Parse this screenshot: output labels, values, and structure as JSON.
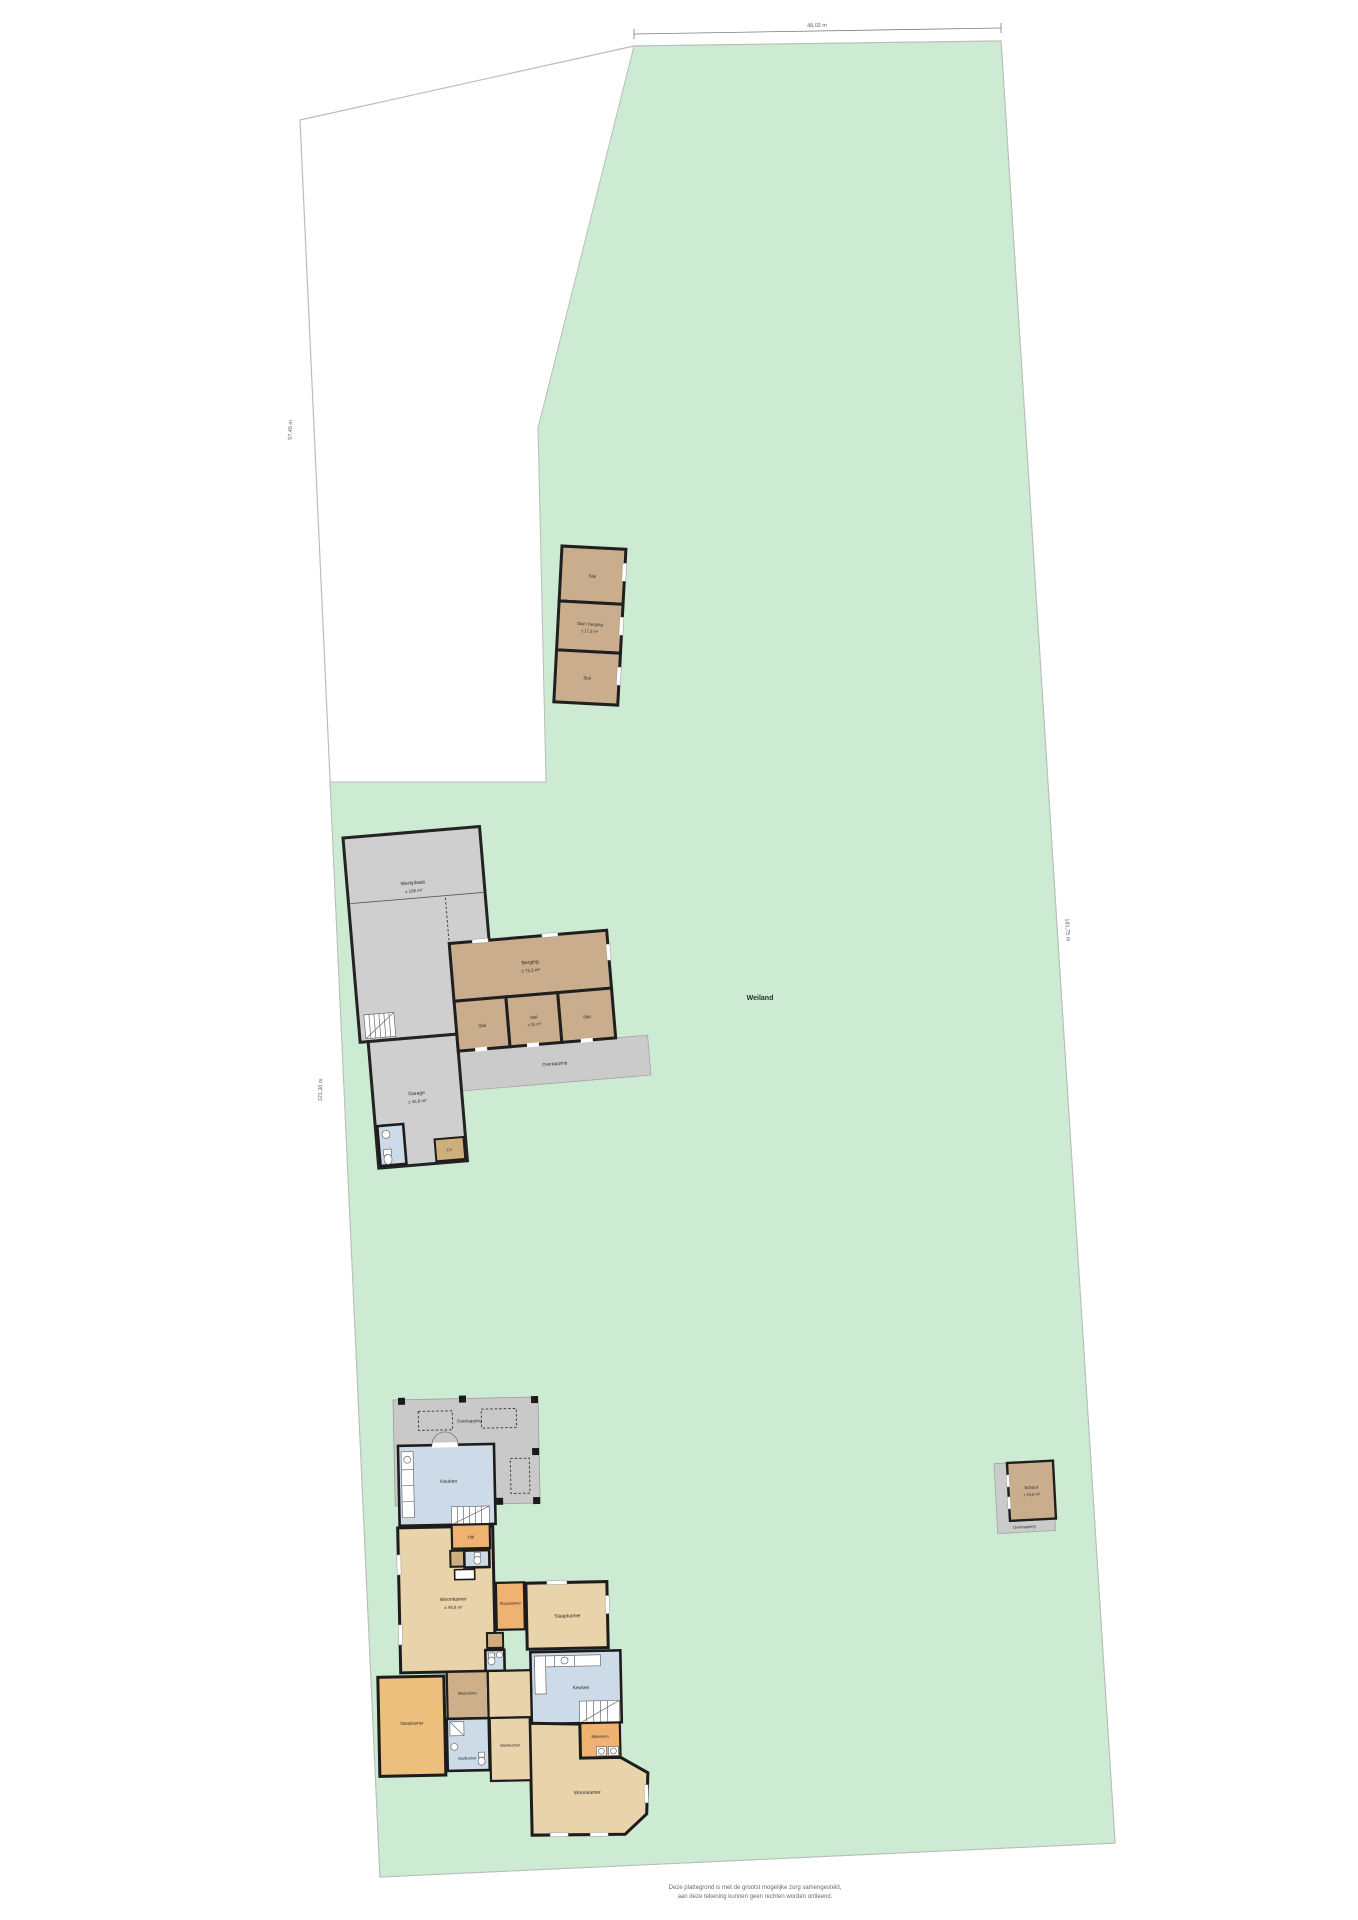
{
  "plan": {
    "field_label": "Weiland",
    "footer_line1": "Deze plattegrond is met de grootst mogelijke zorg samengesteld,",
    "footer_line2": "aan deze tekening kunnen geen rechten worden ontleend.",
    "dimensions": {
      "top": "48,02 m",
      "left_upper": "57,45 m",
      "left_lower": "121,30 m",
      "right": "181,75 m"
    }
  },
  "stable_north": {
    "room1": "Stal",
    "room2_name": "Stal / berging",
    "room2_area": "± 17,2 m²",
    "room3": "Stal"
  },
  "barn": {
    "hall_name": "Werkplaats",
    "hall_area": "± 168 m²",
    "berging_name": "Berging",
    "berging_area": "± 72,5 m²",
    "stal_left": "Stal",
    "stal_mid_name": "Stal",
    "stal_mid_area": "± 15 m²",
    "stal_right": "Stal",
    "overkapping": "Overkapping",
    "garage_name": "Garage",
    "garage_area": "± 46,8 m²",
    "cv": "CV"
  },
  "house": {
    "terrace": "Overkapping",
    "kitchen1": "Keuken",
    "hall": "Hal",
    "living1_name": "Woonkamer",
    "living1_area": "± 48,6 m²",
    "bedroom1": "Slaapkamer",
    "bedroom2": "Slaapkamer",
    "kitchen2": "Keuken",
    "bijkeuken": "Bijkeuken",
    "living2_name": "Woonkamer",
    "bedroom3": "Slaapkamer",
    "bathroom1": "Badkamer",
    "workroom": "Werkkamer",
    "laundry": "Wasruimte"
  },
  "shed_east": {
    "name": "Schuur",
    "area": "± 24,8 m²",
    "apron": "Overkapping"
  },
  "colors": {
    "field_green": "#cdebd2",
    "stable_tan": "#c9ad8c",
    "building_gray": "#cfcfcf",
    "house_tan": "#e8d3ab",
    "room_orange": "#f0b271",
    "wet_room_blue": "#ccdbe7",
    "wall": "#1f1f1f"
  }
}
